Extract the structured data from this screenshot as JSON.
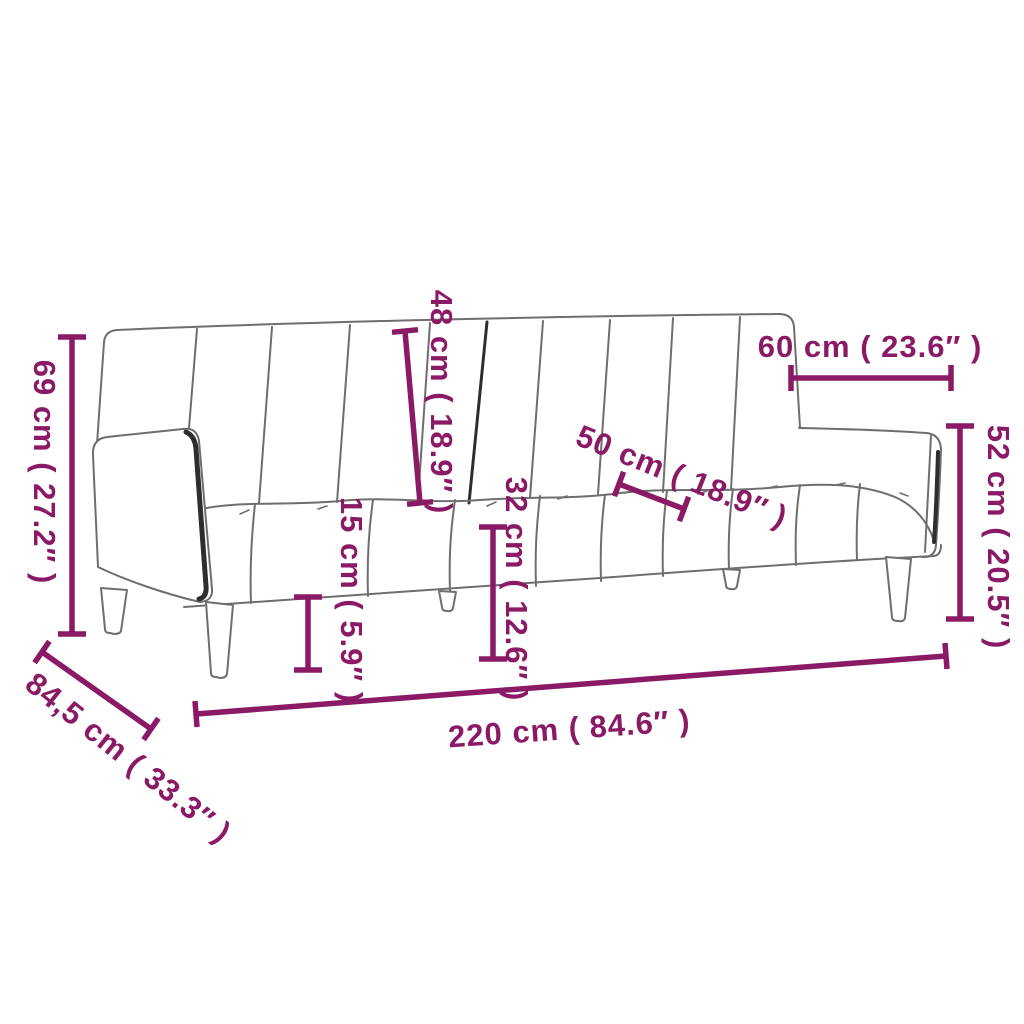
{
  "figure": {
    "type": "product-dimension-diagram",
    "subject": "two-seater sofa bed line drawing",
    "accent_color": "#8a1a66",
    "outline_color": "#6e6e6e",
    "background_color": "#ffffff"
  },
  "dimensions": {
    "overall_height": {
      "label": "69 cm ( 27.2″ )"
    },
    "overall_depth": {
      "label": "84,5 cm ( 33.3″ )"
    },
    "backrest_height": {
      "label": "48 cm ( 18.9″ )"
    },
    "leg_height": {
      "label": "15 cm ( 5.9″ )"
    },
    "seat_height": {
      "label": "32 cm ( 12.6″ )"
    },
    "seat_depth": {
      "label": "50 cm ( 18.9″ )"
    },
    "armrest_length": {
      "label": "60 cm ( 23.6″ )"
    },
    "armrest_height": {
      "label": "52 cm ( 20.5″ )"
    },
    "overall_width": {
      "label": "220 cm ( 84.6″ )"
    }
  }
}
